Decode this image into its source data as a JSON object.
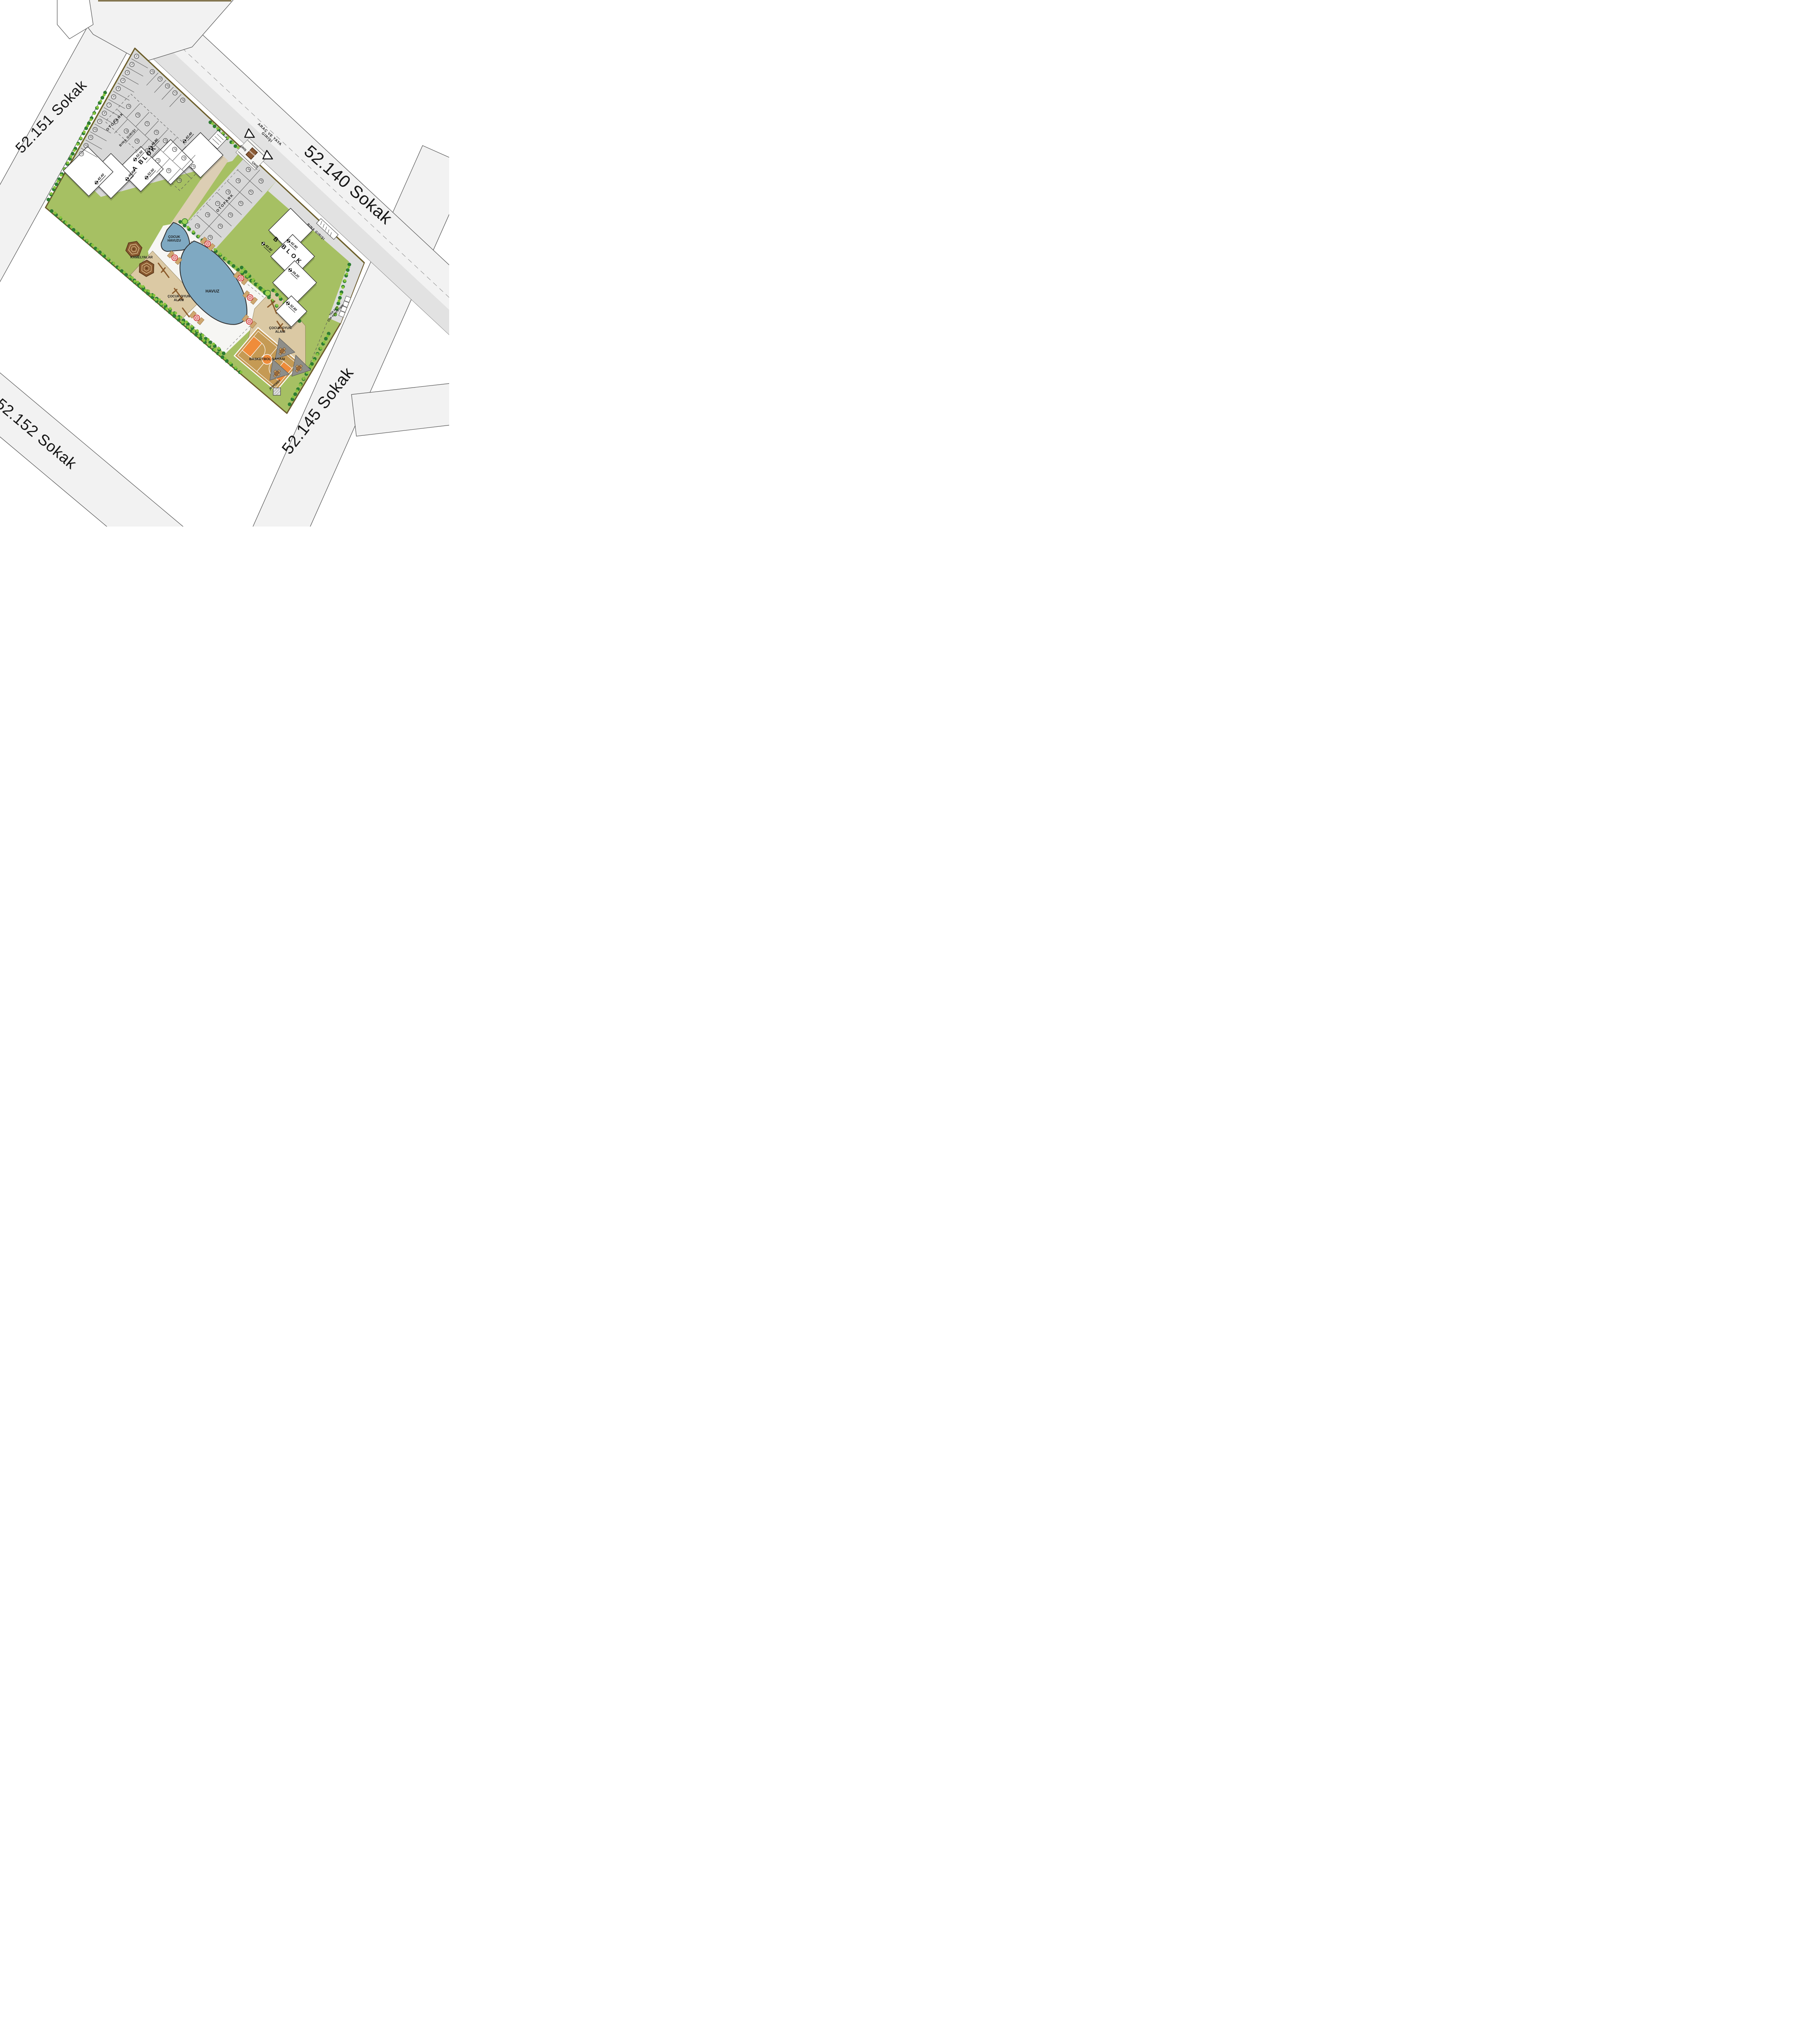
{
  "streets": {
    "nw": "52.151 Sokak",
    "ne": "52.140 Sokak",
    "se": "52.145 Sokak",
    "sw": "52.152 Sokak"
  },
  "entrance": {
    "line1": "ARAÇ VE YAYA",
    "line2": "GİRİŞİ",
    "in": "GİRİŞ",
    "out": "ÇIKIŞ",
    "security": "güvenlik"
  },
  "parking": {
    "label": "OTOPARK",
    "stalls": {
      "left": [
        "1",
        "2",
        "3",
        "4",
        "5",
        "6",
        "7",
        "8",
        "9",
        "10",
        "11",
        "12",
        "13"
      ],
      "top": [
        "14",
        "15",
        "16",
        "17",
        "18"
      ],
      "island_a": [
        "19",
        "20",
        "21",
        "22",
        "23",
        "24",
        "25",
        "26"
      ],
      "island_b": [
        "27",
        "28",
        "29",
        "30",
        "31",
        "32",
        "33"
      ],
      "lot2_a": [
        "34",
        "35",
        "36",
        "37",
        "38",
        "39"
      ],
      "lot2_b": [
        "40",
        "41",
        "42",
        "43",
        "44",
        "45"
      ]
    }
  },
  "blocks": {
    "a": {
      "name": "A BLOK",
      "entrance_label": "BINA GIRIŞI",
      "elevations": [
        "42.40",
        "48.80",
        "52.50",
        "52.50",
        "48.80",
        "42.40"
      ]
    },
    "b": {
      "name": "B BLOK",
      "entrance_label": "BINA GIRIŞI",
      "elevations": [
        "42.90",
        "42.80",
        "39.20",
        "32.80"
      ]
    }
  },
  "amenities": {
    "kids_pool_line1": "ÇOCUK",
    "kids_pool_line2": "HAVUZU",
    "pool": "HAVUZ",
    "gazebos": "KAMELYALAR",
    "playground_line1": "ÇOCUK OYUN",
    "playground_line2": "ALANI",
    "basketball": "BASKETBOL SAHASI",
    "generator": "jeneratör",
    "waste_line1": "YER ALTI",
    "waste_line2": "ÇÖP KONTEYNIRI"
  },
  "colors": {
    "parcel_boundary": "#6b5a2c",
    "street_fill": "#f2f2f2",
    "street_edge": "#4f4f4f",
    "parking_fill": "#d8d8d8",
    "green": "#a6c063",
    "hedge": "#2e7d32",
    "water": "#7fa9c2",
    "plaza": "#f6f6f3",
    "sand": "#dbc9a4",
    "court_base": "#c59a54",
    "court_accent": "#ef8c3a",
    "building": "#ffffff",
    "wood": "#8a5a2b",
    "umbrella": "#cf3a3a",
    "sail": "#8e8e89"
  }
}
